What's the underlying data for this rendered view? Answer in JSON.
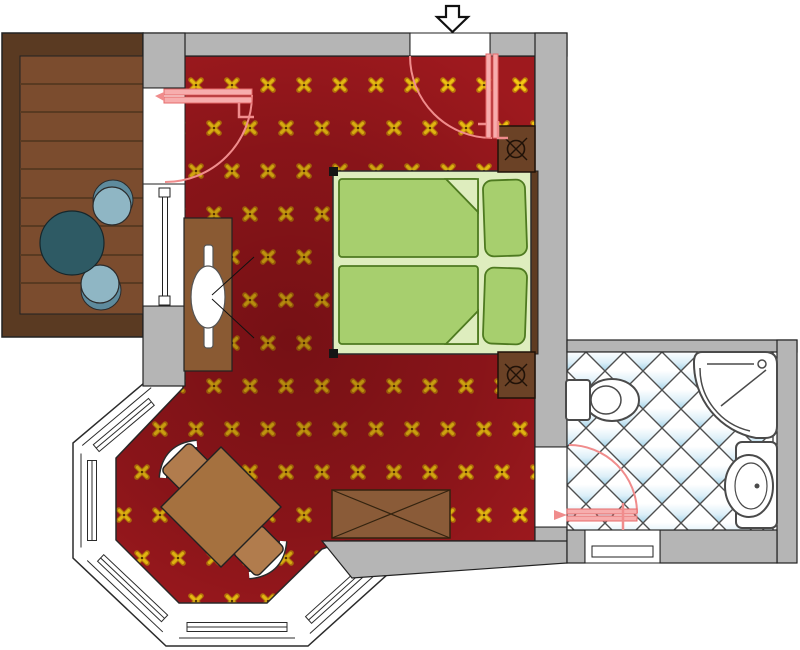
{
  "title": "hotel-room-floor-plan",
  "colors": {
    "wall": "#B5B5B5",
    "wall_outline": "#222222",
    "carpet_base": "#9E191E",
    "carpet_shade": "#2A0003",
    "motif_gold": "#F5C813",
    "motif_outline": "#C17F0A",
    "motif_dot": "#5C3A00",
    "deck_frame": "#5A3A22",
    "deck_plank": "#7B4C2E",
    "deck_plank_line": "#593A21",
    "deck_table": "#2E5A64",
    "deck_chair": "#8FB6C4",
    "deck_chair_shadow": "#5E8B9D",
    "bed_base": "#DEEDBE",
    "duvet": "#A7CF6E",
    "duvet_line": "#4E7A20",
    "headboard": "#5E3B22",
    "nightstand": "#6B4226",
    "nightstand_glyph": "#201208",
    "desk": "#8A5A33",
    "bench": "#8A5B38",
    "bay_table": "#A5713F",
    "bay_chair": "#B17C4D",
    "door_leaf": "#F7ADAD",
    "door_stroke": "#E66A6A",
    "door_arc": "#F08C8C",
    "tile_blue": "#AFD8EB",
    "tile_stroke": "#4F4F4F",
    "fixture": "#4A4A4A",
    "white": "#FFFFFF"
  },
  "rooms": [
    {
      "name": "bedroom",
      "floor": "red carpet with gold quatrefoil motif"
    },
    {
      "name": "bathroom",
      "floor": "white diagonal tiles with blue shading"
    },
    {
      "name": "balcony-deck",
      "floor": "wood planks"
    },
    {
      "name": "bay-window",
      "floor": "red carpet"
    }
  ],
  "furniture": [
    "double-bed-with-two-duvets-and-pillows",
    "nightstand-with-lamp-top",
    "nightstand-with-lamp-bottom",
    "dressing-table-with-mirror",
    "luggage-bench",
    "bay-table-with-two-chairs",
    "deck-round-table-with-two-chairs"
  ],
  "fixtures": [
    "toilet",
    "corner-shower",
    "washbasin-counter"
  ],
  "doors": [
    "entry-door",
    "balcony-door",
    "bathroom-door"
  ],
  "symbols": [
    "entrance-arrow"
  ]
}
